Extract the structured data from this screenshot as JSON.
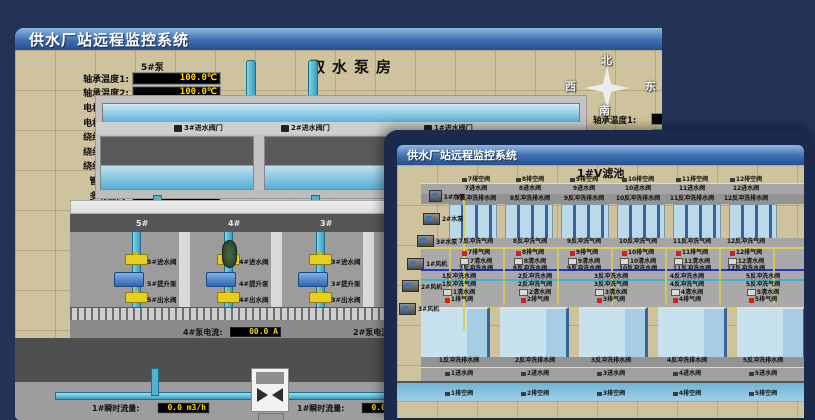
{
  "bw": {
    "title": "供水厂站远程监控系统",
    "scene_title": "取水泵房",
    "panel": {
      "header": "5#泵",
      "rows": [
        {
          "label": "轴承温度1:",
          "value": "100.0℃"
        },
        {
          "label": "轴承温度2:",
          "value": "100.0℃"
        },
        {
          "label": "电机温度1:",
          "value": "18.1℃"
        },
        {
          "label": "电机温度2:",
          "value": "17.9℃"
        },
        {
          "label": "绕组温度1:",
          "value": "18.0℃"
        },
        {
          "label": "绕组温度2:",
          "value": "18.1℃"
        },
        {
          "label": "绕组温度3:",
          "value": "18.1℃"
        },
        {
          "label": "管道压力:",
          "value": "0.0007MPa"
        },
        {
          "label": "多功能阀:",
          "value": "0%"
        }
      ]
    },
    "compass": {
      "north": "北",
      "south": "南",
      "west": "西",
      "east": "东"
    },
    "side_labels": [
      "轴承温度1:",
      "轴承温度2:"
    ],
    "inlet_gate_valves": [
      "3#进水阀门",
      "2#进水阀门",
      "1#进水阀门"
    ],
    "bay_numbers": [
      "5#",
      "4#",
      "3#",
      "2#"
    ],
    "bays": [
      {
        "inlet": "5#进水阀",
        "pump": "5#提升泵",
        "outlet": "5#出水阀"
      },
      {
        "inlet": "4#进水阀",
        "pump": "4#提升泵",
        "outlet": "4#出水阀"
      },
      {
        "inlet": "3#进水阀",
        "pump": "3#提升泵",
        "outlet": "3#出水阀"
      },
      {
        "inlet": "2#进水阀",
        "pump": "2#提升泵",
        "outlet": "2#出水阀"
      }
    ],
    "current_readouts": [
      {
        "label": "4#泵电流:",
        "value": "00.0 A"
      },
      {
        "label": "2#泵电流:",
        "value": ""
      }
    ],
    "flow_readouts": [
      {
        "label": "1#瞬时流量:",
        "value": "0.0 m3/h"
      },
      {
        "label": "1#瞬时流量:",
        "value": "0.0 m3/h"
      }
    ]
  },
  "fw": {
    "title": "供水厂站远程监控系统",
    "scene_title": "1#V滤池",
    "equipment": [
      "1#水泵",
      "2#水泵",
      "3#水泵",
      "1#风机",
      "2#风机",
      "3#风机"
    ],
    "upper": {
      "drain": [
        "7排空阀",
        "8排空阀",
        "9排空阀",
        "10排空阀",
        "11排空阀",
        "12排空阀"
      ],
      "inlet": [
        "7进水阀",
        "8进水阀",
        "9进水阀",
        "10进水阀",
        "11进水阀",
        "12进水阀"
      ],
      "backwash_drain": [
        "7反冲洗排水阀",
        "8反冲洗排水阀",
        "9反冲洗排水阀",
        "10反冲洗排水阀",
        "11反冲洗排水阀",
        "12反冲洗排水阀"
      ],
      "backwash_air": [
        "7反冲洗气阀",
        "8反冲洗气阀",
        "9反冲洗气阀",
        "10反冲洗气阀",
        "11反冲洗气阀",
        "12反冲洗气阀"
      ],
      "air_release": [
        "7排气阀",
        "8排气阀",
        "9排气阀",
        "10排气阀",
        "11排气阀",
        "12排气阀"
      ],
      "clear_water": [
        "7清水阀",
        "8清水阀",
        "9清水阀",
        "10清水阀",
        "11清水阀",
        "12清水阀"
      ],
      "backwash_water": [
        "7反冲洗水阀",
        "8反冲洗水阀",
        "9反冲洗水阀",
        "10反冲洗水阀",
        "11反冲洗水阀",
        "12反冲洗水阀"
      ]
    },
    "lower": {
      "backwash_water": [
        "1反冲洗水阀",
        "2反冲洗水阀",
        "3反冲洗水阀",
        "4反冲洗水阀",
        "5反冲洗水阀",
        "6反冲洗水阀"
      ],
      "backwash_air": [
        "1反冲洗气阀",
        "2反冲洗气阀",
        "3反冲洗气阀",
        "4反冲洗气阀",
        "5反冲洗气阀",
        "6反冲洗气阀"
      ],
      "clear_water": [
        "1清水阀",
        "2清水阀",
        "3清水阀",
        "4清水阀",
        "5清水阀",
        "6清水阀"
      ],
      "air_release": [
        "1排气阀",
        "2排气阀",
        "3排气阀",
        "4排气阀",
        "5排气阀",
        "6排气阀"
      ],
      "backwash_drain": [
        "1反冲洗排水阀",
        "2反冲洗排水阀",
        "3反冲洗排水阀",
        "4反冲洗排水阀",
        "5反冲洗排水阀",
        "6反冲洗排水阀"
      ],
      "inlet": [
        "1进水阀",
        "2进水阀",
        "3进水阀",
        "4进水阀",
        "5进水阀",
        "6进水阀"
      ],
      "drain": [
        "1排空阀",
        "2排空阀",
        "3排空阀",
        "4排空阀",
        "5排空阀",
        "6排空阀"
      ]
    }
  }
}
